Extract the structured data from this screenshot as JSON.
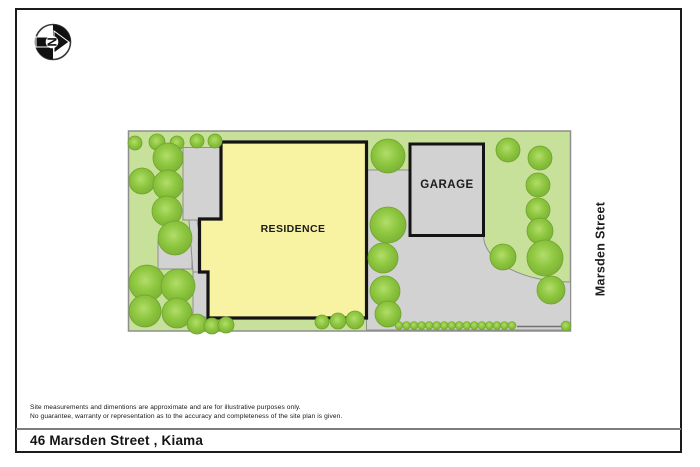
{
  "page": {
    "compass": {
      "letter": "N"
    },
    "footer": {
      "disclaimer_line1": "Site measurements and dimentions are approximate and are for illustrative purposes only.",
      "disclaimer_line2": "No guarantee, warranty or representation as to the accuracy and completeness of the site plan is given.",
      "address": "46 Marsden Street , Kiama"
    }
  },
  "site_plan": {
    "labels": {
      "residence": "RESIDENCE",
      "garage": "GARAGE",
      "street": "Marsden Street"
    },
    "colors": {
      "lawn": "#c8e19a",
      "tree_core": "#b2dd6a",
      "tree_mid": "#8dc63f",
      "tree_rim": "#7cb236",
      "tree_edge": "#6ea32d",
      "residence": "#f8f3a2",
      "hardscape": "#d2d2d2",
      "hardscape_border": "#8f8f8f",
      "outline": "#141414",
      "lot_border": "#8e8e8e"
    },
    "lot": {
      "x": 128.5,
      "y": 131,
      "w": 442,
      "h": 200
    },
    "residence_polygon": [
      [
        221,
        142
      ],
      [
        366.5,
        142
      ],
      [
        366.5,
        318
      ],
      [
        208,
        318
      ],
      [
        208,
        272
      ],
      [
        199.5,
        272
      ],
      [
        199.5,
        219
      ],
      [
        221,
        219
      ]
    ],
    "garage_rect": {
      "x": 410,
      "y": 144,
      "w": 73.5,
      "h": 91.5
    },
    "driveway_path": "M 366.5 170 L 410 170 L 410 235.5 L 483.5 235.5 A 87 46.5 0 0 0 570.5 282 L 570.5 330 L 366.5 330 Z",
    "patios": [
      {
        "x": 183,
        "y": 147.5,
        "w": 39,
        "h": 72.5
      },
      {
        "x": 193,
        "y": 272,
        "w": 14,
        "h": 45
      },
      {
        "x": 158,
        "y": 240,
        "w": 34,
        "h": 29
      }
    ],
    "path_connector": [
      [
        189,
        220
      ],
      [
        197,
        220
      ],
      [
        205,
        272
      ],
      [
        193,
        272
      ]
    ],
    "fence_line": {
      "x1": 517,
      "y1": 326.5,
      "x2": 566,
      "y2": 326.5
    },
    "trees": [
      [
        135,
        143,
        7
      ],
      [
        157,
        142,
        8
      ],
      [
        177,
        143,
        7
      ],
      [
        197,
        141,
        7
      ],
      [
        215,
        141,
        7
      ],
      [
        168,
        158,
        15
      ],
      [
        142,
        181,
        13
      ],
      [
        168,
        185,
        15
      ],
      [
        167,
        211,
        15
      ],
      [
        175,
        238,
        17
      ],
      [
        147,
        283,
        18
      ],
      [
        178,
        286,
        17
      ],
      [
        145,
        311,
        16
      ],
      [
        177,
        313,
        15
      ],
      [
        197,
        324,
        10
      ],
      [
        212,
        326,
        8
      ],
      [
        226,
        325,
        8
      ],
      [
        322,
        322,
        7
      ],
      [
        338,
        321,
        8
      ],
      [
        355,
        320,
        9
      ],
      [
        388,
        156,
        17
      ],
      [
        388,
        225,
        18
      ],
      [
        383,
        258,
        15
      ],
      [
        385,
        291,
        15
      ],
      [
        388,
        314,
        13
      ],
      [
        508,
        150,
        12
      ],
      [
        540,
        158,
        12
      ],
      [
        538,
        185,
        12
      ],
      [
        538,
        210,
        12
      ],
      [
        540,
        231,
        13
      ],
      [
        503,
        257,
        13
      ],
      [
        545,
        258,
        18
      ],
      [
        551,
        290,
        14
      ]
    ],
    "hedge_row": {
      "y": 325.5,
      "x_start": 399,
      "x_end": 512,
      "count": 16,
      "r": 4
    },
    "hedge_end_bush": [
      566,
      326,
      5
    ]
  }
}
